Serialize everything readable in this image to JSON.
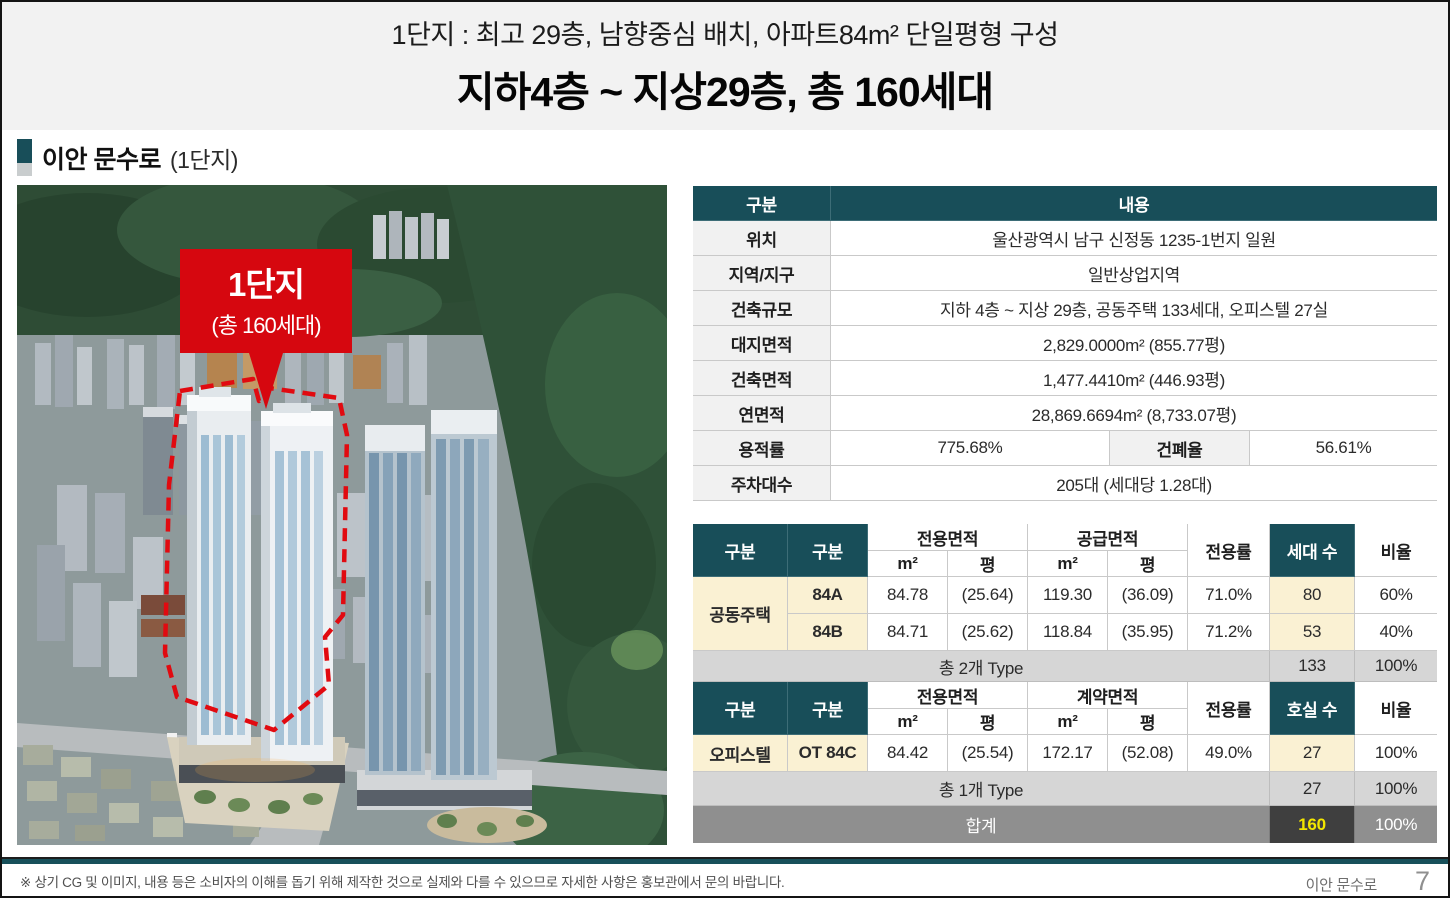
{
  "header": {
    "line1": "1단지 : 최고 29층, 남향중심 배치, 아파트84m² 단일평형 구성",
    "line2": "지하4층 ~ 지상29층, 총 160세대"
  },
  "section": {
    "title": "이안 문수로",
    "suffix": "(1단지)"
  },
  "photo": {
    "callout_title": "1단지",
    "callout_sub": "(총 160세대)"
  },
  "info": {
    "col_label": "구분",
    "col_value": "내용",
    "rows": [
      {
        "label": "위치",
        "value": "울산광역시 남구 신정동 1235-1번지 일원"
      },
      {
        "label": "지역/지구",
        "value": "일반상업지역"
      },
      {
        "label": "건축규모",
        "value": "지하 4층 ~ 지상 29층, 공동주택 133세대, 오피스텔 27실"
      },
      {
        "label": "대지면적",
        "value": "2,829.0000m² (855.77평)"
      },
      {
        "label": "건축면적",
        "value": "1,477.4410m² (446.93평)"
      },
      {
        "label": "연면적",
        "value": "28,869.6694m² (8,733.07평)"
      }
    ],
    "far": {
      "label": "용적률",
      "value": "775.68%"
    },
    "bcr": {
      "label": "건폐율",
      "value": "56.61%"
    },
    "parking": {
      "label": "주차대수",
      "value": "205대 (세대당 1.28대)"
    }
  },
  "apt": {
    "h_gubun1": "구분",
    "h_gubun2": "구분",
    "h_exclusive": "전용면적",
    "h_supply": "공급면적",
    "h_m2": "m²",
    "h_py": "평",
    "h_rate": "전용률",
    "h_count": "세대 수",
    "h_ratio": "비율",
    "category": "공동주택",
    "rows": [
      {
        "type": "84A",
        "ex_m2": "84.78",
        "ex_py": "(25.64)",
        "sp_m2": "119.30",
        "sp_py": "(36.09)",
        "rate": "71.0%",
        "count": "80",
        "ratio": "60%"
      },
      {
        "type": "84B",
        "ex_m2": "84.71",
        "ex_py": "(25.62)",
        "sp_m2": "118.84",
        "sp_py": "(35.95)",
        "rate": "71.2%",
        "count": "53",
        "ratio": "40%"
      }
    ],
    "subtotal": {
      "label": "총 2개 Type",
      "count": "133",
      "ratio": "100%"
    }
  },
  "ot": {
    "h_gubun1": "구분",
    "h_gubun2": "구분",
    "h_exclusive": "전용면적",
    "h_contract": "계약면적",
    "h_m2": "m²",
    "h_py": "평",
    "h_rate": "전용률",
    "h_count": "호실 수",
    "h_ratio": "비율",
    "category": "오피스텔",
    "rows": [
      {
        "type": "OT 84C",
        "ex_m2": "84.42",
        "ex_py": "(25.54)",
        "ct_m2": "172.17",
        "ct_py": "(52.08)",
        "rate": "49.0%",
        "count": "27",
        "ratio": "100%"
      }
    ],
    "subtotal": {
      "label": "총 1개 Type",
      "count": "27",
      "ratio": "100%"
    },
    "total": {
      "label": "합계",
      "count": "160",
      "ratio": "100%"
    }
  },
  "footer": {
    "disclaimer": "※ 상기 CG 및 이미지, 내용 등은 소비자의 이해를 돕기 위해 제작한 것으로 실제와 다를 수 있으므로 자세한 사항은 홍보관에서 문의 바랍니다.",
    "brand": "이안 문수로",
    "page_number": "7"
  },
  "colors": {
    "teal": "#184e59",
    "red": "#d6070f",
    "cream": "#faf1d3",
    "subtotal_gray": "#d6d6d6",
    "total_gray": "#8f8f8f",
    "total_dark": "#3f3f3f",
    "total_yellow": "#f3e600"
  }
}
